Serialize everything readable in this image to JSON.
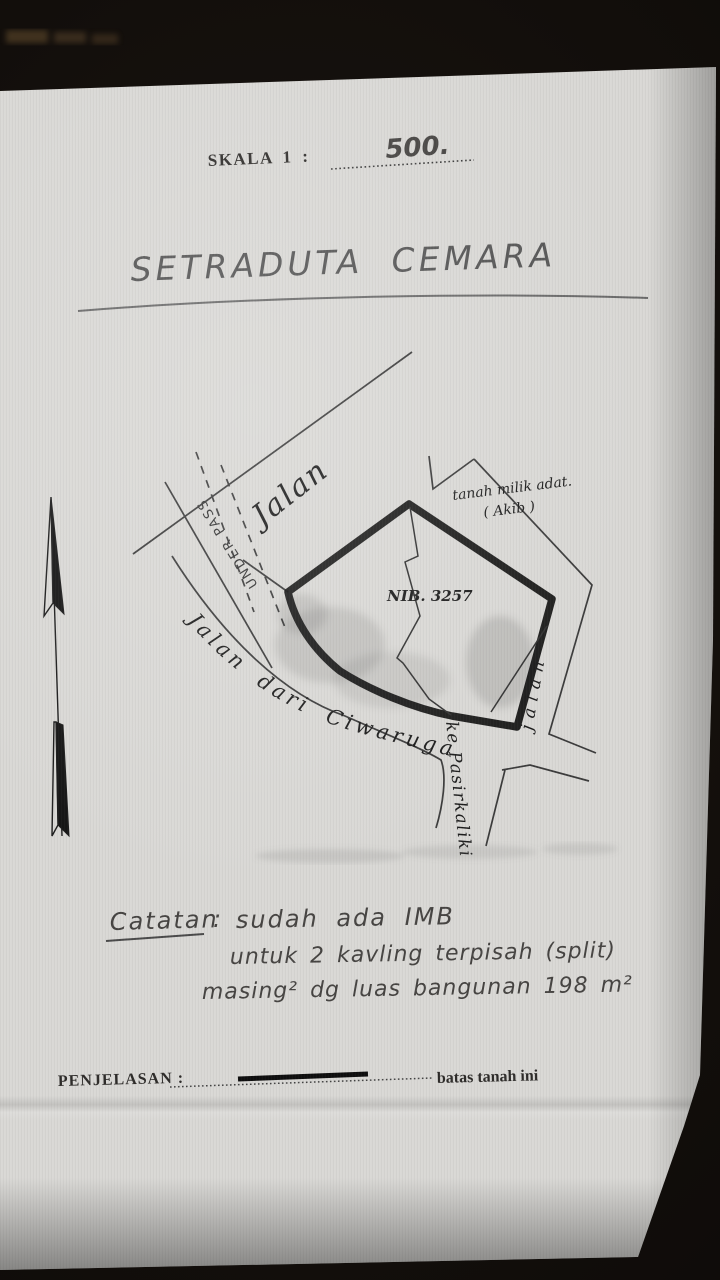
{
  "document": {
    "scale": {
      "label": "SKALA 1 :",
      "value": "500."
    },
    "title": "SETRADUTA CEMARA",
    "map": {
      "road_top_label": "Jalan",
      "underpass_label": "UNDER PASS",
      "adjacent_land_line1": "tanah milik adat.",
      "adjacent_land_line2": "( Akib )",
      "parcel_number": "NIB. 3257",
      "road_main_label": "Jalan dari Ciwaruga",
      "road_main_label2": "ke Pasirkaliki",
      "road_right_label": "jalan"
    },
    "notes": {
      "heading": "Catatan",
      "colon": ":",
      "line1": "sudah ada IMB",
      "line2": "untuk 2 kavling terpisah (split)",
      "line3": "masing² dg luas bangunan 198 m²"
    },
    "legend": {
      "label": "PENJELASAN :",
      "text": "batas tanah ini"
    }
  },
  "colors": {
    "ink": "#161616",
    "pencil": "#555555",
    "paper": "#d9d8d5",
    "backdrop": "#0f0c0a"
  }
}
